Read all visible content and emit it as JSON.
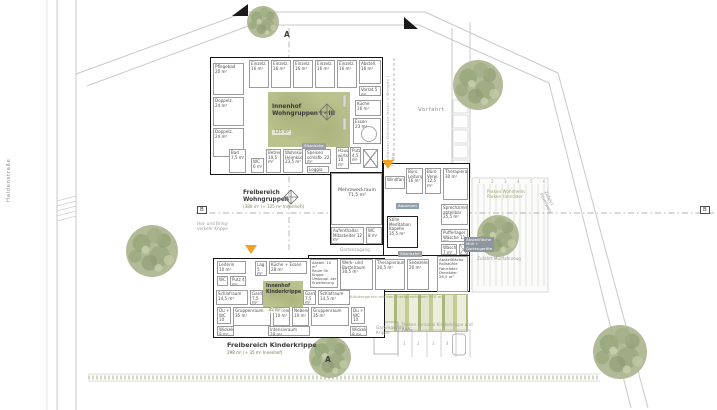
{
  "markers": {
    "a": "A",
    "b": "B"
  },
  "streets": {
    "haldenstrasse": "Haldenstraße",
    "vorfahrt": "Vorfahrt",
    "kleinbusse": "Stellflächen Kleinbusse Holen + Bringen | 10 Min",
    "feuerwehr": "Zufahrt\nFeuerwehr"
  },
  "areas": {
    "innenhof_wg": {
      "title": "Innenhof\nWohngruppen I - III",
      "area": "125 m²"
    },
    "freibereich_wg": {
      "title": "Freibereich\nWohngruppen",
      "area": "(380 m² (+ 125 m² Innenhof))"
    },
    "innenhof_krippe": {
      "title": "Innenhof\nKinderkrippe",
      "area": "35 m²"
    },
    "freibereich_krippe": {
      "title": "Freibereich Kinderkrippe",
      "area": "298 m² (+ 35 m² Innenhof)"
    },
    "kraeutergarten": "Kräutergarten mit den Therapiebäumen 970 m²"
  },
  "notes": {
    "gartenzugang": "Gartenzugang",
    "muellzufahrt": "Zufahrt Müllfahrzeug",
    "holbring": "Hol- und Bring-\nverkehr Krippe",
    "parken_wohnheim": "Parken Wohnheim\nParken Fahrräder",
    "parken_personal": "Parken Personal Kinderkrippe und\nAWG",
    "gartengeraete": "Gartengeräte\nKrippe"
  },
  "chips": {
    "aquarium": "Aquarium",
    "sitznische_1": "Sitznische",
    "sitznische_2": "Sitznische",
    "abstell_muell": "Abstellfläche\nMüll +\nGartengeräte"
  },
  "stalls_top": [
    "1",
    "2",
    "3",
    "4",
    "5",
    "6"
  ],
  "stalls_bottom": [
    "1",
    "2",
    "3",
    "4"
  ],
  "rooms": {
    "wohngruppen": [
      {
        "label": "Pflegebad\n20 m²"
      },
      {
        "label": "Doppelz.\n24 m²"
      },
      {
        "label": "Doppelz.\n24 m²"
      },
      {
        "label": "Einzelz.\n16 m²"
      },
      {
        "label": "Einzelz.\n16 m²"
      },
      {
        "label": "Einzelz.\n16 m²"
      },
      {
        "label": "Einzelz.\n16 m²"
      },
      {
        "label": "Einzelz.\n16 m²"
      },
      {
        "label": "Abstell.\n16 m²"
      },
      {
        "label": "Vorrat 5 m²"
      },
      {
        "label": "Küche\n16 m²"
      },
      {
        "label": "Essen\n23 m²"
      },
      {
        "label": "Bad\n7,5 m²"
      },
      {
        "label": "WC\n6 m²"
      },
      {
        "label": "Betreuer\n10,5 m²"
      },
      {
        "label": "Wohnküche\nHeimküche\n23,5 m²"
      },
      {
        "label": "Speisen\nschlafb. 22 m²"
      },
      {
        "label": "Loggia 10 m²"
      },
      {
        "label": "Hausw.\nwirts.\n10 m²"
      },
      {
        "label": "Putz\n4,5 m²"
      }
    ],
    "mitte": [
      {
        "label": "Mehrzweckraum\n71,5 m²"
      },
      {
        "label": "Aufenthaltsr.\nMitarbeiter 12 m²"
      },
      {
        "label": "WC\n8 m²"
      },
      {
        "label": "Windfang"
      },
      {
        "label": "Büro\nLeitung\n16 m²"
      },
      {
        "label": "Büro\nVerw.\n12,5 m²"
      },
      {
        "label": "Therapieraum\n30 m²"
      },
      {
        "label": "Sprechzimmer\nabteilbar\n25,5 m²"
      },
      {
        "label": "Stille\nMeditation\nKapelle\n35,5 m²"
      },
      {
        "label": "Pufferlager\nWäsche 11 m²"
      },
      {
        "label": "Wäschekl.\n7 m²"
      },
      {
        "label": "Wechsel Innen-/\nAussenrollstuhl"
      }
    ],
    "krippe": [
      {
        "label": "Leiterin\n10 m²"
      },
      {
        "label": "WC"
      },
      {
        "label": "Putz 4 m²"
      },
      {
        "label": "Lag.\n5 m²"
      },
      {
        "label": "Küche + Essen\n28 m²"
      },
      {
        "label": "Abstell. 10 m²\nRaum für Krippe\nUmbaupl. bei\nErweiterung"
      },
      {
        "label": "Werk- und\nBastelraum\n30,5 m²"
      },
      {
        "label": "Therapieraum\n30,5 m²"
      },
      {
        "label": "Snoezelen\n20 m²"
      },
      {
        "label": "Abstellfläche\nRollstühle\nFahrräder\nDreiräder\n26,5 m²"
      },
      {
        "label": "Schlafraum\n14,5 m²"
      },
      {
        "label": "Gard.\n7,5 m²"
      },
      {
        "label": "Gard.\n7,5 m²"
      },
      {
        "label": "Schlafraum\n14,5 m²"
      },
      {
        "label": "Du +\nWC\n10 m²"
      },
      {
        "label": "Gruppenraum\n35 m²"
      },
      {
        "label": "Nebenr.\n10 m²"
      },
      {
        "label": "Nebenr.\n10 m²"
      },
      {
        "label": "Gruppenraum\n35 m²"
      },
      {
        "label": "Du +\nWC\n10 m²"
      },
      {
        "label": "Wickeln\n8 m²"
      },
      {
        "label": "Intensivraum\n28 m²"
      },
      {
        "label": "Wickeln\n8 m²"
      }
    ]
  }
}
